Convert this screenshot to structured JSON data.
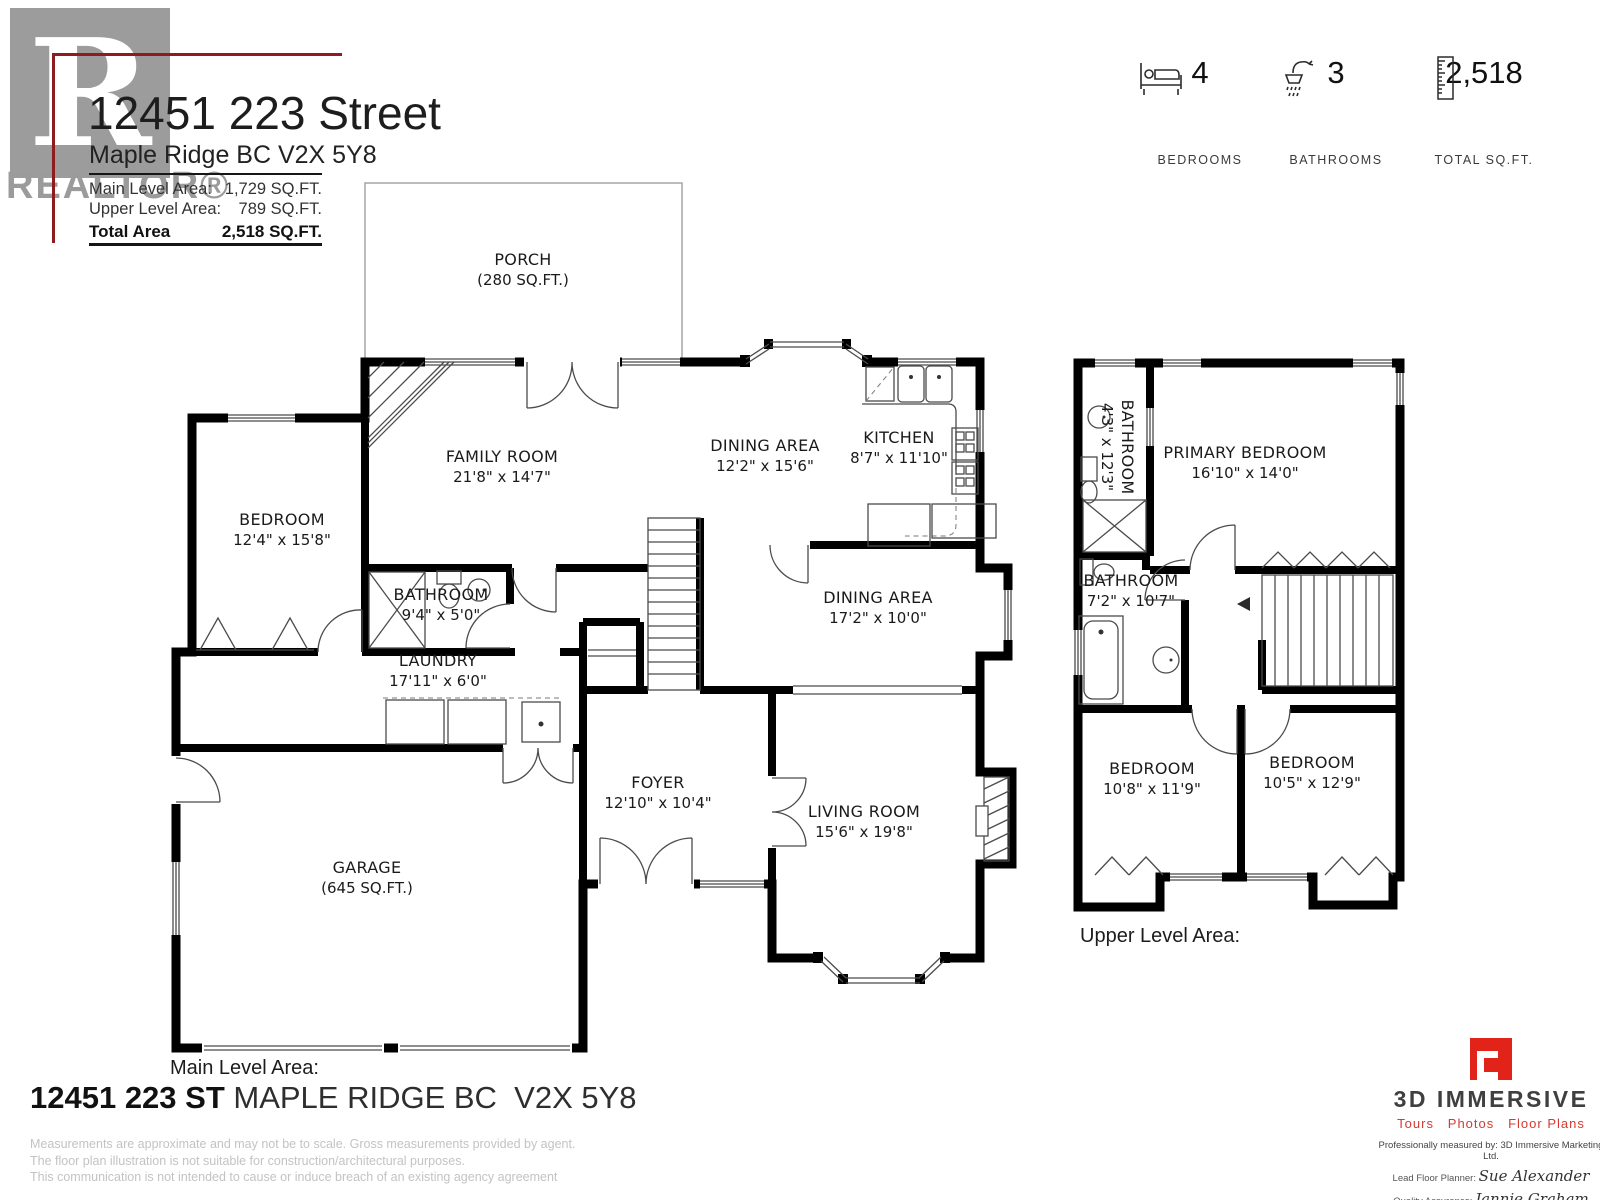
{
  "header": {
    "logo_letter": "R",
    "logo_wordmark": "REALTOR®",
    "title": "12451 223 Street",
    "subtitle": "Maple Ridge BC V2X 5Y8",
    "areas": [
      {
        "label": "Main Level Area:",
        "value": "1,729 SQ.FT."
      },
      {
        "label": "Upper Level Area:",
        "value": "789 SQ.FT."
      },
      {
        "label": "Total Area",
        "value": "2,518  SQ.FT."
      }
    ]
  },
  "stats": [
    {
      "value": "4",
      "label": "BEDROOMS",
      "icon": "bed-icon"
    },
    {
      "value": "3",
      "label": "BATHROOMS",
      "icon": "shower-icon"
    },
    {
      "value": "2,518",
      "label": "TOTAL SQ.FT.",
      "icon": "ruler-icon"
    }
  ],
  "main_level": {
    "caption": "Main Level Area:",
    "rooms": [
      {
        "name": "PORCH",
        "dims": "(280 SQ.FT.)"
      },
      {
        "name": "FAMILY ROOM",
        "dims": "21'8\" x 14'7\""
      },
      {
        "name": "DINING AREA",
        "dims": "12'2\" x 15'6\""
      },
      {
        "name": "KITCHEN",
        "dims": "8'7\" x 11'10\""
      },
      {
        "name": "BEDROOM",
        "dims": "12'4\" x 15'8\""
      },
      {
        "name": "BATHROOM",
        "dims": "9'4\" x 5'0\""
      },
      {
        "name": "LAUNDRY",
        "dims": "17'11\" x 6'0\""
      },
      {
        "name": "DINING AREA",
        "dims": "17'2\" x 10'0\""
      },
      {
        "name": "FOYER",
        "dims": "12'10\" x 10'4\""
      },
      {
        "name": "LIVING ROOM",
        "dims": "15'6\" x 19'8\""
      },
      {
        "name": "GARAGE",
        "dims": "(645 SQ.FT.)"
      }
    ]
  },
  "upper_level": {
    "caption": "Upper Level Area:",
    "rooms": [
      {
        "name": "BATHROOM",
        "dims": "4'3\" x 12'3\""
      },
      {
        "name": "PRIMARY BEDROOM",
        "dims": "16'10\" x 14'0\""
      },
      {
        "name": "BATHROOM",
        "dims": "7'2\" x 10'7\""
      },
      {
        "name": "BEDROOM",
        "dims": "10'8\" x 11'9\""
      },
      {
        "name": "BEDROOM",
        "dims": "10'5\" x 12'9\""
      }
    ]
  },
  "footer": {
    "address_bold": "12451 223 ST",
    "address_rest": " MAPLE RIDGE BC  V2X 5Y8",
    "disclaimers": [
      "Measurements are approximate and may not be to scale. Gross measurements provided by agent.",
      "The floor plan illustration is not suitable for construction/architectural purposes.",
      "This communication is not intended to cause or induce breach of an existing agency agreement"
    ]
  },
  "branding": {
    "name": "3D IMMERSIVE",
    "tagline": "Tours   Photos   Floor Plans",
    "measured_by": "Professionally measured by: 3D Immersive Marketing Ltd.",
    "planner_label": "Lead Floor Planner:",
    "planner_name": "Sue Alexander",
    "qa_label": "Quality Assurance:",
    "qa_name": "Jannie Graham"
  },
  "colors": {
    "accent_dark_red": "#8e1b1f",
    "brand_red": "#e2231a",
    "wall_black": "#000000",
    "logo_gray": "#9c9c9c"
  }
}
